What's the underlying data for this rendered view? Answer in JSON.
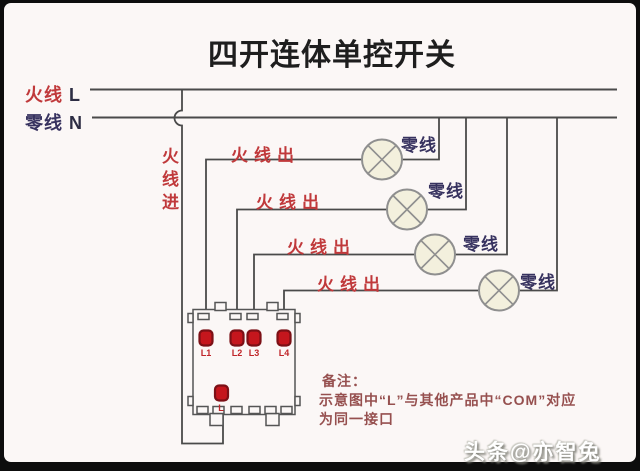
{
  "title": "四开连体单控开关",
  "legend": {
    "hot_label": "火线",
    "hot_letter": "L",
    "neutral_label": "零线",
    "neutral_letter": "N"
  },
  "feed_label": "火线进",
  "live_out_labels": [
    "火线出",
    "火线出",
    "火线出",
    "火线出"
  ],
  "neutral_labels": [
    "零线",
    "零线",
    "零线",
    "零线"
  ],
  "switch": {
    "terminal_labels": [
      "L1",
      "L2",
      "L3",
      "L4"
    ],
    "common_label": "L"
  },
  "notes": {
    "heading": "备注：",
    "line1": "示意图中“L”与其他产品中“COM”对应",
    "line2": "为同一接口"
  },
  "watermark": "头条@亦智兔",
  "colors": {
    "hot_text": "#c0393b",
    "neutral_text": "#37325f",
    "wire": "#4a4a4a",
    "lamp_fill": "#f3f0dd",
    "lamp_stroke": "#8f8f8f",
    "terminal_fill": "#c5161d",
    "terminal_stroke": "#7c1016",
    "note_text": "#96504f"
  }
}
